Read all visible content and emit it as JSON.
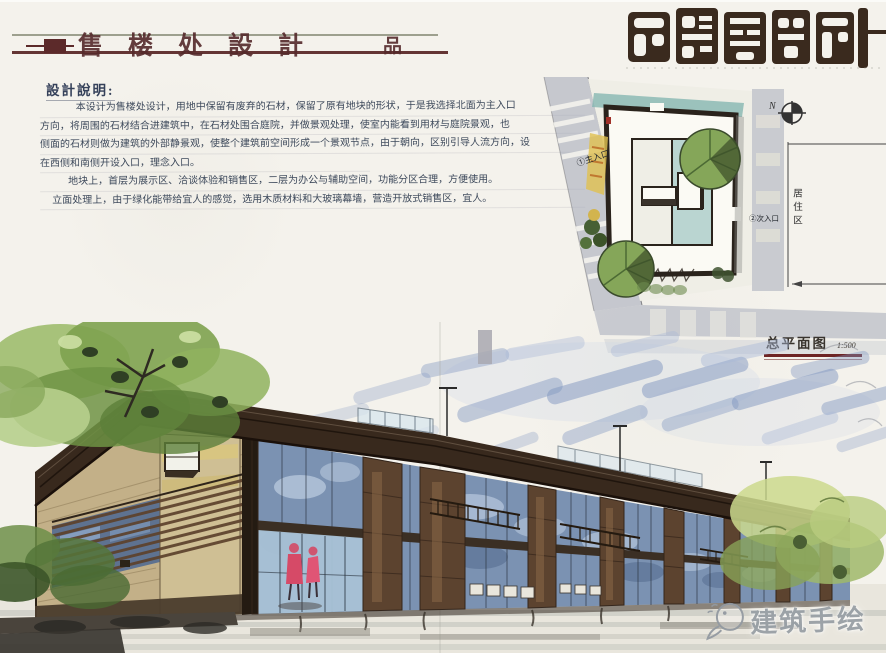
{
  "header": {
    "title": "售楼处設計",
    "seal": "品"
  },
  "logo": {
    "text": "售楼处設計"
  },
  "notes": {
    "heading": "設計說明:",
    "lines": [
      "本设计为售楼处设计，用地中保留有废弃的石材，保留了原有地块的形状，于是我选择北面为主入口",
      "方向，将周围的石材结合进建筑中，在石材处围合庭院，并做景观处理，使室内能看到用材与庭院景观，也",
      "侧面的石材则做为建筑的外部静景观，使整个建筑前空间形成一个景观节点，由于朝向，区别引导人流方向，设",
      "在西侧和南侧开设入口，理念入口。",
      "地块上，首层为展示区、洽谈体验和销售区，二层为办公与辅助空间，功能分区合理，方便使用。",
      "立面处理上，由于绿化能带给宜人的感觉，选用木质材料和大玻璃幕墙，营造开放式销售区，宜人。"
    ]
  },
  "site_plan": {
    "north": "N",
    "labels": {
      "main_entrance": "①主入口",
      "secondary_entrance": "②次入口",
      "residential": "居住区"
    },
    "caption": {
      "title": "总平面图",
      "scale": "1:500"
    }
  },
  "watermark": {
    "brand": "建筑手绘"
  },
  "palette": {
    "ink": "#4a3a30",
    "maroon": "#5c2a2a",
    "sky_wash": "#8096c0",
    "glass": "#7b92b2",
    "wood": "#5c432f",
    "stone": "#c3b088",
    "foliage": "#7da055",
    "teal_water": "#7fb3ae",
    "road_gray": "#a6abba",
    "figure_red": "#d64a67",
    "watermark_gray": "#99a0a6"
  }
}
